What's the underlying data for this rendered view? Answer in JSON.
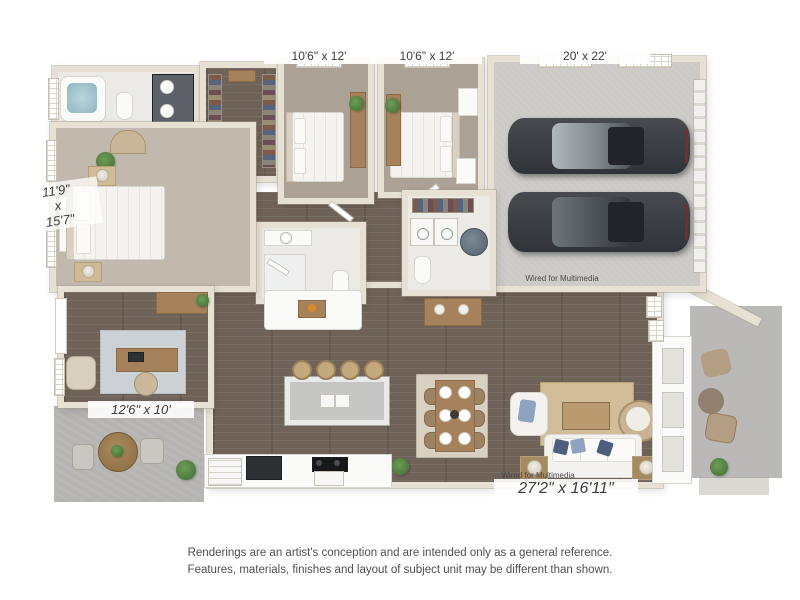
{
  "plan": {
    "labels": {
      "bedroom2": "10'6\" x 12'",
      "bedroom3": "10'6\" x 12'",
      "garage": "20' x 22'",
      "master_l1": "11'9\"",
      "master_l2": "x",
      "master_l3": "15'7\"",
      "office": "12'6\" x 10'",
      "living": "27'2\" x 16'11\"",
      "wired_garage": "Wired for Multimedia",
      "wired_living": "Wired for Multimedia"
    }
  },
  "disclaimer": {
    "line1": "Renderings are an artist's conception and are intended only as a general reference.",
    "line2": "Features, materials, finishes and layout of subject unit may be different than shown."
  },
  "colors": {
    "wall": "#e7e1d4",
    "tile": "#eceae6",
    "carpet": "#aca195",
    "carpet_master": "#c2b9ae",
    "wood_floor": "#6f6359",
    "garage_floor": "#cbcac7",
    "patio": "#b5b4b1",
    "accent_wood": "#a5825c",
    "car_body": "#3a3e42",
    "sofa_pillow_navy": "#4e5f7d",
    "sofa_pillow_blue": "#8fa3c0",
    "rug_living": "#d1bd98",
    "rug_dining": "#d8d1c2",
    "rug_office": "#ccd1d5"
  }
}
